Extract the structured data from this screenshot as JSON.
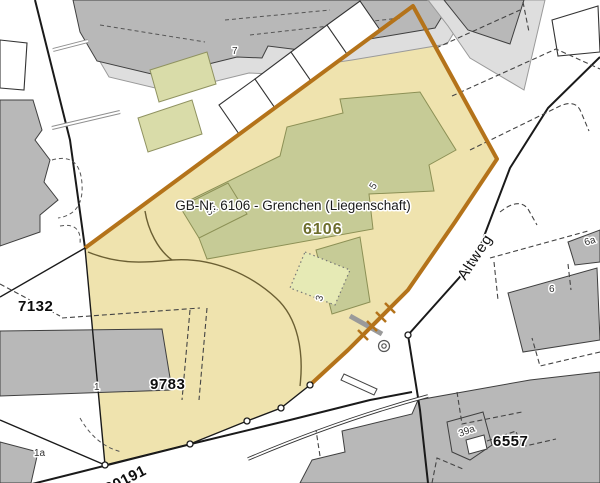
{
  "map_viewer": {
    "tooltip": {
      "text": "GB-Nr. 6106 - Grenchen (Liegenschaft)"
    },
    "selected_parcel": {
      "number": "6106"
    },
    "parcel_labels": {
      "p7132": "7132",
      "p9783": "9783",
      "p6557": "6557",
      "p20191": "20191"
    },
    "street_labels": {
      "altweg": "Altweg"
    },
    "house_numbers": {
      "h7": "7",
      "h5a": "5a",
      "h5": "5",
      "h3": "3",
      "h1": "1",
      "h1a": "1a",
      "h39a": "39a",
      "h6a": "6a",
      "h6": "6"
    },
    "colors": {
      "parcel_fill": "#efe3ae",
      "parcel_border": "#b4731a",
      "selected_label": "#6d6d2c",
      "building_fill": "#b8b8b8",
      "green_building_fill": "#c6cb96"
    }
  }
}
